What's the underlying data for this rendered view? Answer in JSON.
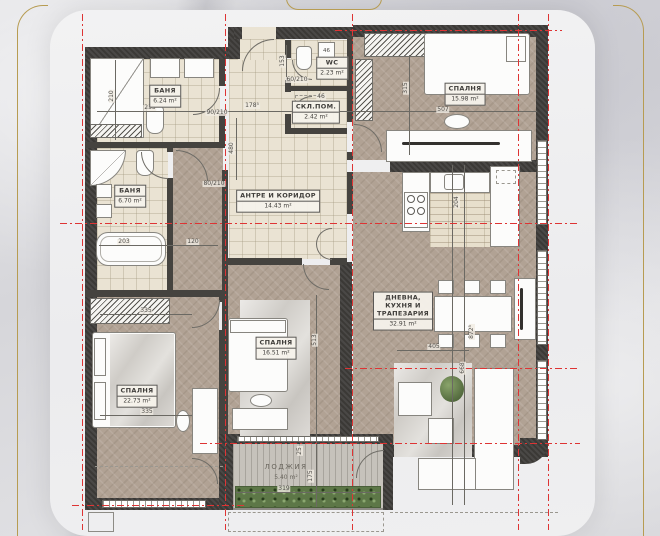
{
  "scene": {
    "kind": "apartment floor plan"
  },
  "colors": {
    "gold_accent": "#b79c52",
    "wall": "#3b3936",
    "axis_red": "#de3434",
    "wood_floor": "#b1a294",
    "tile_floor": "#eae3d3",
    "marble_background": "#d9d9dc",
    "card": "#efeff0",
    "hedge_green": "#5d7747"
  },
  "rooms": [
    {
      "id": "bath-1",
      "name": "БАНЯ",
      "area": "6.24 m²"
    },
    {
      "id": "bath-2",
      "name": "БАНЯ",
      "area": "6.70 m²"
    },
    {
      "id": "wc",
      "name": "WC",
      "area": "2.23 m²"
    },
    {
      "id": "storage",
      "name": "СКЛ.ПОМ.",
      "area": "2.42 m²"
    },
    {
      "id": "hall",
      "name": "АНТРЕ И КОРИДОР",
      "area": "14.43 m²"
    },
    {
      "id": "bedroom-1",
      "name": "СПАЛНЯ",
      "area": "15.98 m²"
    },
    {
      "id": "living-kitchen",
      "name": "ДНЕВНА, КУХНЯ И ТРАПЕЗАРИЯ",
      "area": "32.91 m²"
    },
    {
      "id": "bedroom-2",
      "name": "СПАЛНЯ",
      "area": "16.51 m²"
    },
    {
      "id": "bedroom-3",
      "name": "СПАЛНЯ",
      "area": "22.73 m²"
    },
    {
      "id": "loggia",
      "name": "ЛОДЖИЯ",
      "area": "5.40 m²"
    }
  ],
  "appliance": {
    "label": "46"
  },
  "dims": [
    {
      "label": "210",
      "x": 112,
      "y": 96,
      "v": 1
    },
    {
      "label": "235",
      "x": 150,
      "y": 108
    },
    {
      "label": "178⁵",
      "x": 252,
      "y": 106
    },
    {
      "label": "480",
      "x": 232,
      "y": 148,
      "v": 1
    },
    {
      "label": "153",
      "x": 283,
      "y": 61,
      "v": 1
    },
    {
      "label": "46",
      "x": 321,
      "y": 97
    },
    {
      "label": "315",
      "x": 406,
      "y": 88,
      "v": 1
    },
    {
      "label": "507",
      "x": 443,
      "y": 110
    },
    {
      "label": "203",
      "x": 124,
      "y": 242
    },
    {
      "label": "120",
      "x": 193,
      "y": 242
    },
    {
      "label": "335",
      "x": 146,
      "y": 311
    },
    {
      "label": "335",
      "x": 147,
      "y": 412
    },
    {
      "label": "513",
      "x": 315,
      "y": 340,
      "v": 1
    },
    {
      "label": "204",
      "x": 457,
      "y": 202,
      "v": 1
    },
    {
      "label": "405",
      "x": 434,
      "y": 347
    },
    {
      "label": "872⁵",
      "x": 472,
      "y": 332,
      "v": 1
    },
    {
      "label": "668",
      "x": 463,
      "y": 368,
      "v": 1
    },
    {
      "label": "319",
      "x": 284,
      "y": 489
    },
    {
      "label": "175",
      "x": 311,
      "y": 476,
      "v": 1
    },
    {
      "label": "25",
      "x": 300,
      "y": 451,
      "v": 1
    },
    {
      "label": "90/210",
      "x": 217,
      "y": 113
    },
    {
      "label": "80/210",
      "x": 214,
      "y": 184
    },
    {
      "label": "60/210",
      "x": 297,
      "y": 80
    }
  ]
}
